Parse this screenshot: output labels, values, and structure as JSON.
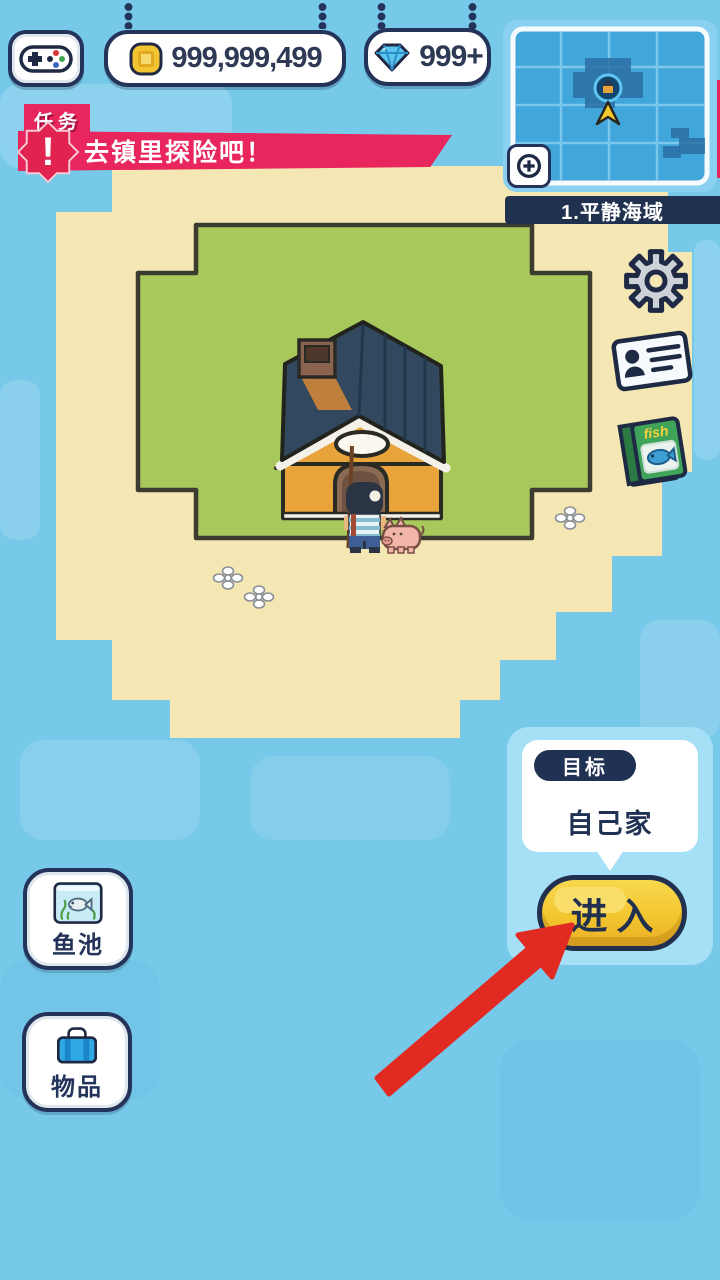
{
  "colors": {
    "water": "#77C9EA",
    "water_light": "#9AD9F3",
    "sand": "#F5E7B3",
    "grass": "#A9C85C",
    "navy": "#24335A",
    "banner_red": "#E8255C",
    "button_yellow": "#F5CB35",
    "arrow_red": "#E02A22",
    "map_blue": "#41A6DA",
    "book_green": "#3FA35A",
    "suitcase_blue": "#2FA9E4"
  },
  "top_bar": {
    "menu_icon": "gamepad-icon",
    "coins": {
      "icon": "coin-icon",
      "value": "999,999,499"
    },
    "gems": {
      "icon": "gem-icon",
      "value": "999+"
    }
  },
  "task": {
    "tag": "任务",
    "exclamation": "!",
    "text": "去镇里探险吧！"
  },
  "minimap": {
    "name": "1.平静海域",
    "zoom_icon": "zoom-in-icon"
  },
  "side_icons": {
    "settings": "gear-icon",
    "profile": "id-card-icon",
    "fish_book": "fish-book-icon"
  },
  "book": {
    "title": "fish"
  },
  "goal": {
    "label": "目标",
    "target": "自己家",
    "enter": "进入"
  },
  "corner_buttons": {
    "fish_pond": "鱼池",
    "items": "物品"
  }
}
